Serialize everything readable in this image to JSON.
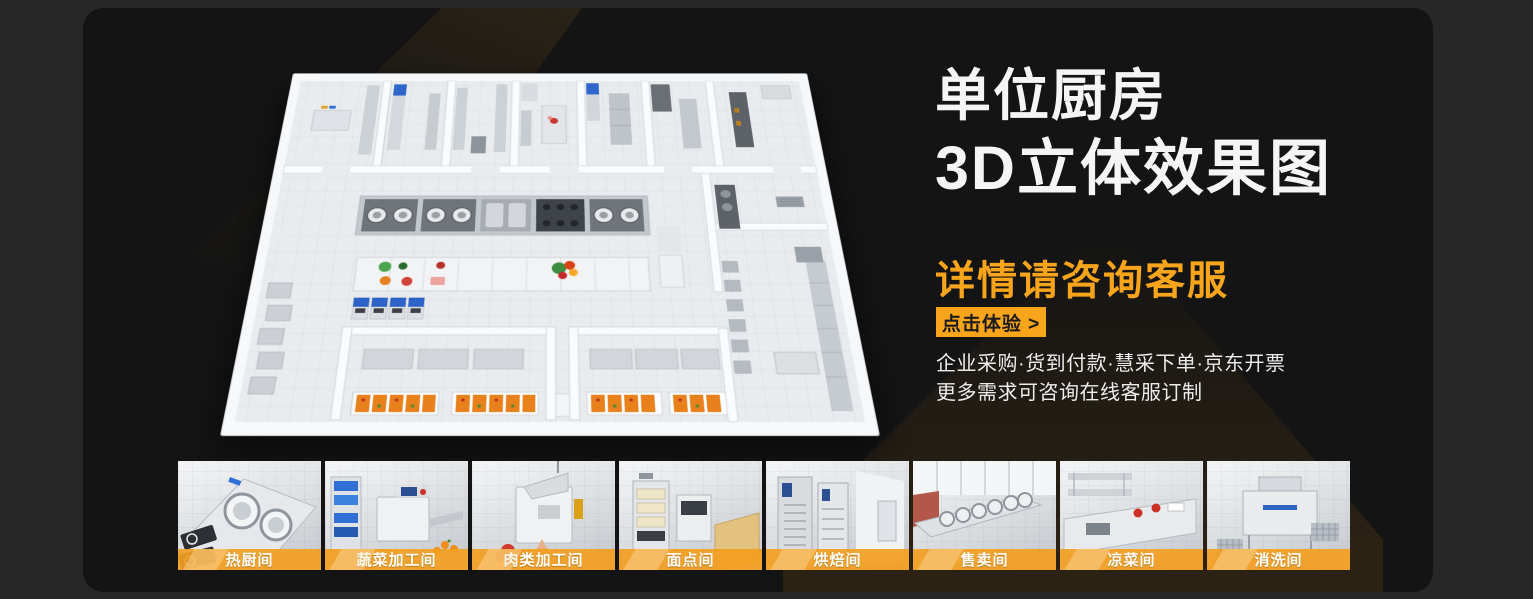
{
  "banner": {
    "title_line1": "单位厨房",
    "title_line2": "3D立体效果图",
    "subtitle": "详情请咨询客服",
    "cta_label": "点击体验 >",
    "info_line1": "企业采购·货到付款·慧采下单·京东开票",
    "info_line2": "更多需求可咨询在线客服订制",
    "colors": {
      "accent": "#F9A51C",
      "card_bg": "#141414",
      "page_bg": "#272727",
      "headline_text": "#F5F5F5",
      "cta_text": "#1C1C1C"
    }
  },
  "thumbnails": [
    {
      "label": "热厨间"
    },
    {
      "label": "蔬菜加工间"
    },
    {
      "label": "肉类加工间"
    },
    {
      "label": "面点间"
    },
    {
      "label": "烘焙间"
    },
    {
      "label": "售卖间"
    },
    {
      "label": "凉菜间"
    },
    {
      "label": "消洗间"
    }
  ]
}
